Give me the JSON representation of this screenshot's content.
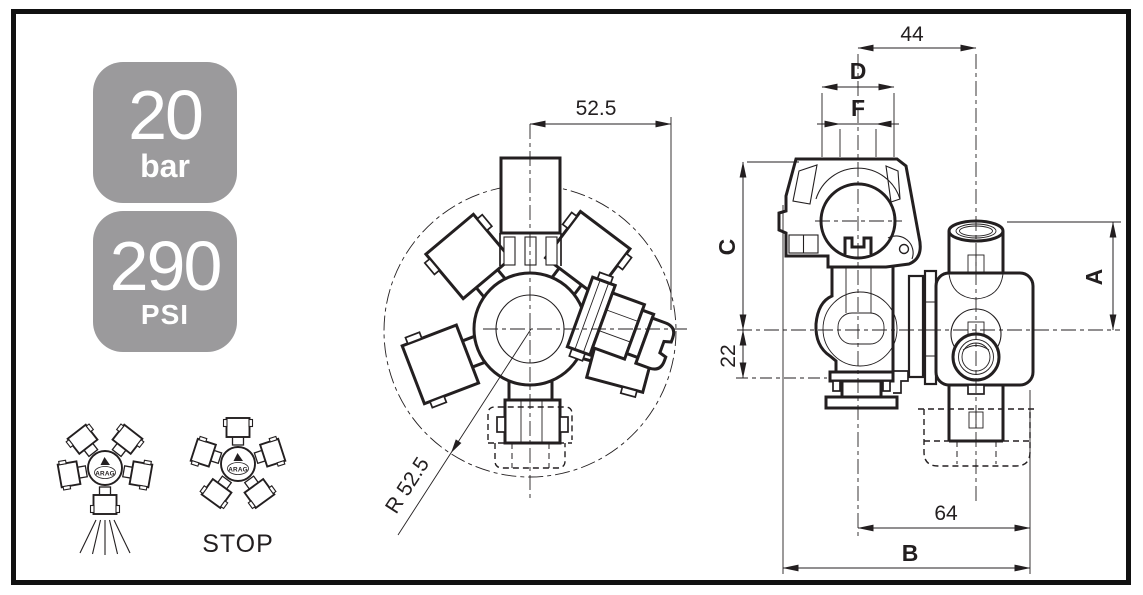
{
  "pressure_badges": [
    {
      "value": "20",
      "unit": "bar"
    },
    {
      "value": "290",
      "unit": "PSI"
    }
  ],
  "position_icons": {
    "brand_label": "ARAG",
    "stop_label": "STOP"
  },
  "front_view": {
    "width_dim": "52.5",
    "radius_dim": "R 52.5"
  },
  "side_view": {
    "top_width_dim": "44",
    "cap_width_dim": "D",
    "thread_width_dim": "F",
    "upper_height_dim": "C",
    "lower_height_dim": "22",
    "fitting_height_dim": "A",
    "inner_width_dim": "64",
    "overall_width_dim": "B"
  },
  "colors": {
    "line": "#231f20",
    "badge_gray": "#9b9a9c",
    "background": "#ffffff"
  }
}
